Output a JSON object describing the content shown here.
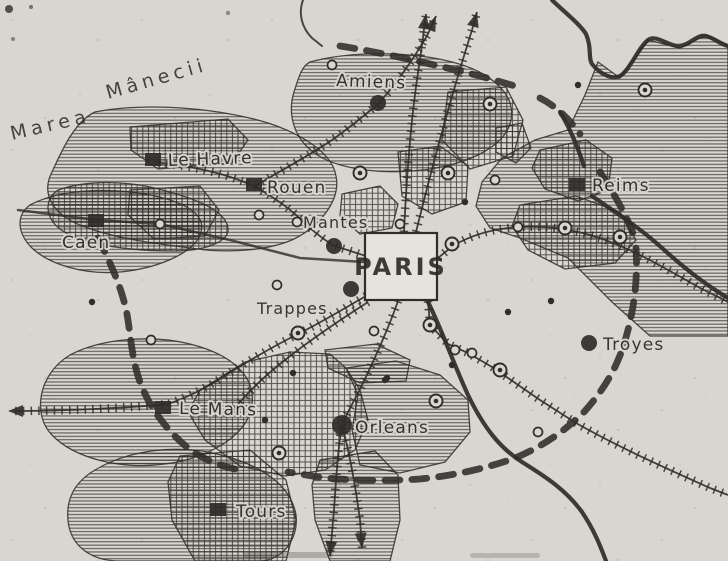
{
  "map": {
    "colors": {
      "paper": "#d9d6d0",
      "ink": "#2f2d29",
      "paris_box_fill": "#e6e3dc"
    },
    "sea_label": {
      "word1": "Marea",
      "word2": "Mânecii"
    },
    "paris": {
      "label": "PARIS"
    },
    "cities": [
      {
        "name": "Le Havre",
        "marker": "square",
        "mx": 153,
        "my": 160,
        "r": 8,
        "lx": 168,
        "ly": 166,
        "fs": 17,
        "rot": -2
      },
      {
        "name": "Rouen",
        "marker": "square",
        "mx": 254,
        "my": 185,
        "r": 8,
        "lx": 267,
        "ly": 193,
        "fs": 17,
        "rot": 0
      },
      {
        "name": "Caen",
        "marker": "square",
        "mx": 96,
        "my": 221,
        "r": 8,
        "lx": 62,
        "ly": 248,
        "fs": 17,
        "rot": 0
      },
      {
        "name": "Amiens",
        "marker": "dot",
        "mx": 378,
        "my": 103,
        "r": 8,
        "lx": 336,
        "ly": 86,
        "fs": 17,
        "rot": 2
      },
      {
        "name": "Mantes",
        "marker": "dot",
        "mx": 334,
        "my": 246,
        "r": 8,
        "lx": 303,
        "ly": 228,
        "fs": 16,
        "rot": 0
      },
      {
        "name": "Trappes",
        "marker": "dot",
        "mx": 351,
        "my": 289,
        "r": 8,
        "lx": 257,
        "ly": 314,
        "fs": 16,
        "rot": 0
      },
      {
        "name": "Reims",
        "marker": "square",
        "mx": 577,
        "my": 185,
        "r": 9,
        "lx": 592,
        "ly": 191,
        "fs": 17,
        "rot": 0
      },
      {
        "name": "Troyes",
        "marker": "dot",
        "mx": 589,
        "my": 343,
        "r": 8,
        "lx": 603,
        "ly": 350,
        "fs": 17,
        "rot": 0
      },
      {
        "name": "Le Mans",
        "marker": "square",
        "mx": 163,
        "my": 408,
        "r": 9,
        "lx": 179,
        "ly": 414,
        "fs": 17,
        "rot": 1
      },
      {
        "name": "Orleans",
        "marker": "dot",
        "mx": 342,
        "my": 425,
        "r": 10,
        "lx": 355,
        "ly": 433,
        "fs": 17,
        "rot": 0
      },
      {
        "name": "Tours",
        "marker": "square",
        "mx": 218,
        "my": 510,
        "r": 8,
        "lx": 236,
        "ly": 517,
        "fs": 17,
        "rot": 0
      }
    ],
    "symbols": {
      "concentric_circles": [
        [
          360,
          173
        ],
        [
          448,
          173
        ],
        [
          490,
          104
        ],
        [
          645,
          90
        ],
        [
          620,
          237
        ],
        [
          452,
          244
        ],
        [
          565,
          228
        ],
        [
          430,
          325
        ],
        [
          500,
          370
        ],
        [
          298,
          333
        ],
        [
          279,
          453
        ],
        [
          436,
          401
        ]
      ],
      "open_circles": [
        [
          332,
          65
        ],
        [
          160,
          224
        ],
        [
          259,
          215
        ],
        [
          151,
          340
        ],
        [
          277,
          285
        ],
        [
          400,
          224
        ],
        [
          518,
          227
        ],
        [
          455,
          350
        ],
        [
          472,
          353
        ],
        [
          374,
          331
        ],
        [
          495,
          180
        ],
        [
          538,
          432
        ],
        [
          297,
          222
        ]
      ],
      "small_dots": [
        [
          92,
          302
        ],
        [
          293,
          373
        ],
        [
          265,
          420
        ],
        [
          385,
          380
        ],
        [
          452,
          365
        ],
        [
          508,
          312
        ],
        [
          551,
          301
        ],
        [
          578,
          85
        ],
        [
          387,
          378
        ],
        [
          465,
          202
        ]
      ]
    }
  }
}
